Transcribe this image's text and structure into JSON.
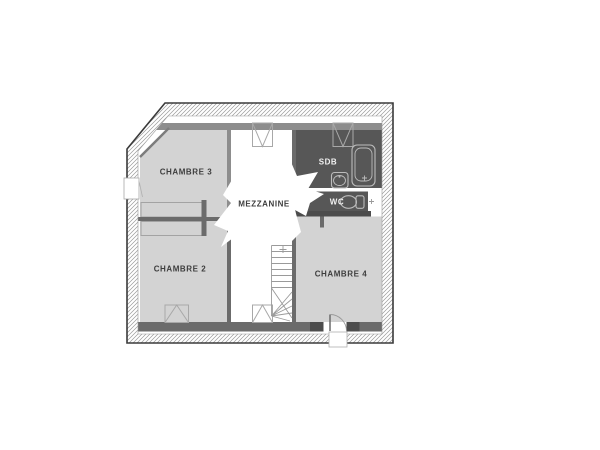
{
  "plan": {
    "title": "first-floor plan",
    "rooms": {
      "chambre3": {
        "label": "CHAMBRE 3",
        "type": "bedroom"
      },
      "chambre2": {
        "label": "CHAMBRE 2",
        "type": "bedroom"
      },
      "chambre4": {
        "label": "CHAMBRE 4",
        "type": "bedroom"
      },
      "mezzanine": {
        "label": "MEZZANINE",
        "type": "landing"
      },
      "sdb": {
        "label": "SDB",
        "type": "bathroom"
      },
      "wc": {
        "label": "WC",
        "type": "toilet"
      }
    },
    "icons": [
      "roof-window-icon",
      "window-icon",
      "bathtub-icon",
      "sink-icon",
      "toilet-icon",
      "staircase-icon",
      "door-swing-icon",
      "opening-burst"
    ],
    "colors": {
      "room_light": "#d3d3d3",
      "room_dark": "#575757",
      "wall_medium": "#8d8d8d",
      "wall_dark": "#6b6b6b",
      "wall_darker": "#4c4c4c",
      "outline": "#3a3a3a",
      "hatch": "#9a9a9a",
      "fixture_line": "#bcbcbc",
      "label_dark": "#3d3d3d",
      "label_light": "#f2f2f2",
      "closet_line": "#a3a3a3",
      "stair_line": "#9a9a9a"
    }
  }
}
